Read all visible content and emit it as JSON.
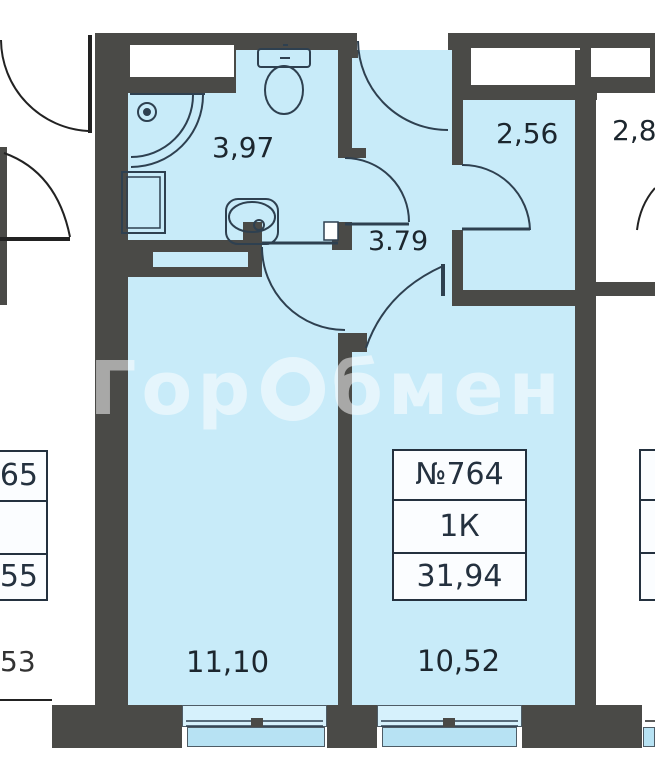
{
  "title": "apartment-floor-plan",
  "watermark": {
    "text": "ГорОбмен",
    "part1": "Гор",
    "part2": "бмен"
  },
  "colors": {
    "wall": "#4a4a47",
    "room_fill": "#c8ebf9",
    "balcony_fill": "#b7e2f3",
    "sill_fill": "#d6f1fc",
    "fixture_line": "#2e4050",
    "label_text": "#1c262e",
    "info_text": "#24313f",
    "watermark_white": "rgba(255,255,255,0.52)"
  },
  "rooms": {
    "bathroom": {
      "area": "3,97"
    },
    "hallway": {
      "area": "3.79"
    },
    "wardrobe": {
      "area": "2,56"
    },
    "living": {
      "area": "11,10"
    },
    "kitchen_living": {
      "area": "10,52"
    }
  },
  "info_box": {
    "number": "№764",
    "type": "1К",
    "total_area": "31,94"
  },
  "neighbors": {
    "right_room_area": "2,8",
    "left_area_fragment": "53",
    "left_info_box": {
      "row1": "65",
      "row2": "",
      "row3": "55"
    }
  },
  "icons": [
    "shower-icon",
    "toilet-icon",
    "sink-icon",
    "washing-machine-icon",
    "door-arc-entrance",
    "door-arc-bathroom",
    "door-arc-living",
    "door-arc-wardrobe",
    "door-arc-kitchen",
    "door-arc-neighbor-left-1",
    "door-arc-neighbor-left-2",
    "door-arc-neighbor-right",
    "window-living",
    "window-kitchen"
  ]
}
